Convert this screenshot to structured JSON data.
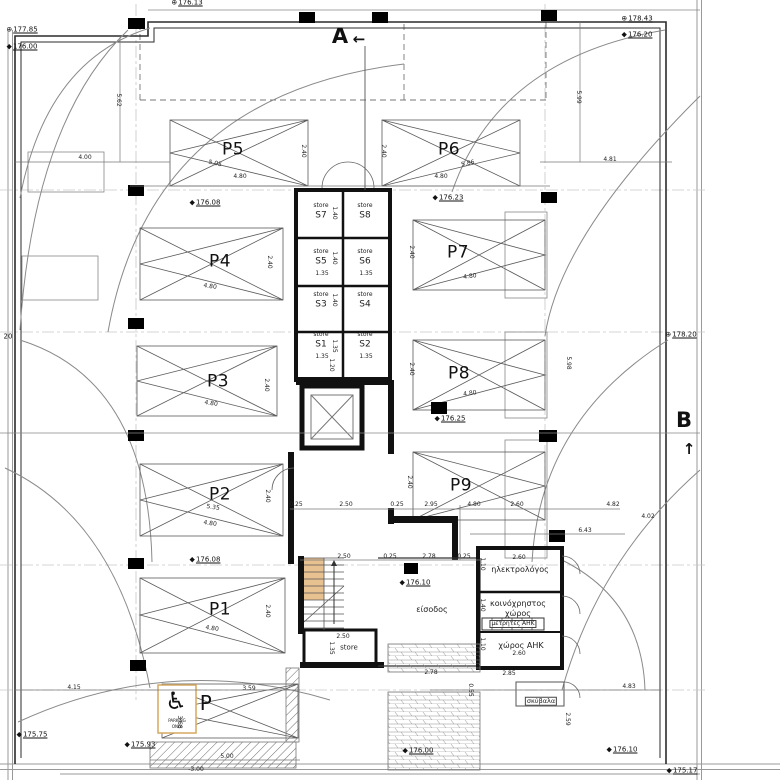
{
  "plan": {
    "colors": {
      "stair-fill": "#e8c191",
      "sign-border": "#d5a95f",
      "wall": "#111111"
    },
    "section_markers": [
      {
        "label": "A",
        "arrow": "←"
      },
      {
        "label": "B",
        "arrow": "↑"
      }
    ],
    "parking_labels": [
      {
        "t": "P5",
        "x": 233,
        "y": 150,
        "name": "parking-label-p5"
      },
      {
        "t": "P6",
        "x": 449,
        "y": 150,
        "name": "parking-label-p6"
      },
      {
        "t": "P4",
        "x": 220,
        "y": 262,
        "name": "parking-label-p4"
      },
      {
        "t": "P7",
        "x": 458,
        "y": 253,
        "name": "parking-label-p7"
      },
      {
        "t": "P3",
        "x": 218,
        "y": 382,
        "name": "parking-label-p3"
      },
      {
        "t": "P8",
        "x": 459,
        "y": 374,
        "name": "parking-label-p8"
      },
      {
        "t": "P2",
        "x": 220,
        "y": 495,
        "name": "parking-label-p2"
      },
      {
        "t": "P9",
        "x": 461,
        "y": 486,
        "name": "parking-label-p9"
      },
      {
        "t": "P1",
        "x": 220,
        "y": 610,
        "name": "parking-label-p1"
      },
      {
        "t": "P",
        "x": 206,
        "y": 703,
        "s": 20,
        "name": "parking-label-accessible"
      }
    ],
    "storage_labels": [
      {
        "t": "store",
        "x": 321,
        "y": 206,
        "s": 6
      },
      {
        "t": "S7",
        "x": 321,
        "y": 216
      },
      {
        "t": "store",
        "x": 365,
        "y": 206,
        "s": 6
      },
      {
        "t": "S8",
        "x": 365,
        "y": 216
      },
      {
        "t": "store",
        "x": 321,
        "y": 252,
        "s": 6
      },
      {
        "t": "S5",
        "x": 321,
        "y": 262
      },
      {
        "t": "store",
        "x": 365,
        "y": 252,
        "s": 6
      },
      {
        "t": "S6",
        "x": 365,
        "y": 262
      },
      {
        "t": "store",
        "x": 321,
        "y": 295,
        "s": 6
      },
      {
        "t": "S3",
        "x": 321,
        "y": 305
      },
      {
        "t": "store",
        "x": 365,
        "y": 295,
        "s": 6
      },
      {
        "t": "S4",
        "x": 365,
        "y": 305
      },
      {
        "t": "store",
        "x": 321,
        "y": 335,
        "s": 6
      },
      {
        "t": "S1",
        "x": 321,
        "y": 345
      },
      {
        "t": "store",
        "x": 365,
        "y": 335,
        "s": 6
      },
      {
        "t": "S2",
        "x": 365,
        "y": 345
      },
      {
        "t": "store",
        "x": 349,
        "y": 648,
        "s": 7
      }
    ],
    "room_labels": [
      {
        "t": "ηλεκτρολόγος",
        "x": 520,
        "y": 570
      },
      {
        "t": "κοινόχρηστος",
        "x": 518,
        "y": 604
      },
      {
        "t": "χώρος",
        "x": 518,
        "y": 614
      },
      {
        "t": "μετρητές ΑΗΚ",
        "x": 513,
        "y": 624,
        "s": 6,
        "box": true
      },
      {
        "t": "χώρος ΑΗΚ",
        "x": 521,
        "y": 646
      },
      {
        "t": "σκύβαλα",
        "x": 541,
        "y": 701,
        "s": 6.5,
        "box": true
      },
      {
        "t": "είσοδος",
        "x": 432,
        "y": 610
      }
    ],
    "elevation_markers": [
      {
        "t": "176.13",
        "x": 187,
        "y": 3,
        "a": "lt",
        "icon": "circle"
      },
      {
        "t": "177.85",
        "x": 22,
        "y": 30,
        "a": "lt",
        "icon": "circle"
      },
      {
        "t": "176.00",
        "x": 22,
        "y": 47,
        "a": "lt",
        "icon": "diamond"
      },
      {
        "t": "178.43",
        "x": 637,
        "y": 19,
        "a": "lt",
        "icon": "circle"
      },
      {
        "t": "176.20",
        "x": 637,
        "y": 35,
        "a": "lt",
        "icon": "diamond"
      },
      {
        "t": "176.08",
        "x": 205,
        "y": 203,
        "a": "lt",
        "icon": "diamond"
      },
      {
        "t": "176.23",
        "x": 448,
        "y": 198,
        "a": "lt",
        "icon": "diamond"
      },
      {
        "t": "178.20",
        "x": 681,
        "y": 335,
        "a": "lt",
        "icon": "circle"
      },
      {
        "t": "176.25",
        "x": 450,
        "y": 419,
        "a": "lt",
        "icon": "diamond"
      },
      {
        "t": "176.08",
        "x": 205,
        "y": 560,
        "a": "lt",
        "icon": "diamond"
      },
      {
        "t": "176.10",
        "x": 415,
        "y": 583,
        "a": "lt",
        "icon": "diamond"
      },
      {
        "t": "175.75",
        "x": 32,
        "y": 735,
        "a": "lt",
        "icon": "diamond"
      },
      {
        "t": "175.93",
        "x": 140,
        "y": 745,
        "a": "lt",
        "icon": "diamond"
      },
      {
        "t": "176.00",
        "x": 418,
        "y": 751,
        "a": "lt",
        "icon": "diamond"
      },
      {
        "t": "176.10",
        "x": 622,
        "y": 750,
        "a": "lt",
        "icon": "diamond"
      },
      {
        "t": "175.17",
        "x": 682,
        "y": 771,
        "a": "lt",
        "icon": "diamond"
      }
    ],
    "dimensions": [
      {
        "t": "5.62",
        "x": 118,
        "y": 100,
        "r": 90
      },
      {
        "t": "5.99",
        "x": 578,
        "y": 97,
        "r": 90
      },
      {
        "t": "4.00",
        "x": 85,
        "y": 158
      },
      {
        "t": "4.81",
        "x": 610,
        "y": 160
      },
      {
        "t": "5.05",
        "x": 215,
        "y": 164,
        "r": 12
      },
      {
        "t": "4.80",
        "x": 240,
        "y": 177
      },
      {
        "t": "5.86",
        "x": 468,
        "y": 164,
        "r": -12
      },
      {
        "t": "4.80",
        "x": 441,
        "y": 177
      },
      {
        "t": "2.40",
        "x": 303,
        "y": 151,
        "r": 90
      },
      {
        "t": "2.40",
        "x": 383,
        "y": 151,
        "r": 90
      },
      {
        "t": "2.40",
        "x": 269,
        "y": 262,
        "r": 90
      },
      {
        "t": "4.80",
        "x": 210,
        "y": 287,
        "r": 8
      },
      {
        "t": "2.40",
        "x": 411,
        "y": 252,
        "r": 90
      },
      {
        "t": "4.80",
        "x": 470,
        "y": 277,
        "r": -8
      },
      {
        "t": "2.40",
        "x": 266,
        "y": 385,
        "r": 90
      },
      {
        "t": "4.80",
        "x": 211,
        "y": 404,
        "r": 8
      },
      {
        "t": "2.40",
        "x": 411,
        "y": 369,
        "r": 90
      },
      {
        "t": "4.80",
        "x": 470,
        "y": 394,
        "r": -8
      },
      {
        "t": "2.40",
        "x": 267,
        "y": 496,
        "r": 90
      },
      {
        "t": "5.35",
        "x": 213,
        "y": 508,
        "r": 8
      },
      {
        "t": "4.80",
        "x": 210,
        "y": 524,
        "r": 8
      },
      {
        "t": "2.40",
        "x": 409,
        "y": 482,
        "r": 90
      },
      {
        "t": "2.40",
        "x": 267,
        "y": 611,
        "r": 90
      },
      {
        "t": "4.80",
        "x": 212,
        "y": 629,
        "r": 8
      },
      {
        "t": "1.40",
        "x": 334,
        "y": 213,
        "r": 90
      },
      {
        "t": "1.40",
        "x": 334,
        "y": 258,
        "r": 90
      },
      {
        "t": "1.40",
        "x": 334,
        "y": 300,
        "r": 90
      },
      {
        "t": "1.35",
        "x": 322,
        "y": 274
      },
      {
        "t": "1.35",
        "x": 366,
        "y": 274
      },
      {
        "t": "1.35",
        "x": 334,
        "y": 346,
        "r": 90
      },
      {
        "t": "1.35",
        "x": 322,
        "y": 357
      },
      {
        "t": "1.35",
        "x": 366,
        "y": 357
      },
      {
        "t": "1.20",
        "x": 331,
        "y": 365,
        "r": 90
      },
      {
        "t": "0.25",
        "x": 296,
        "y": 505
      },
      {
        "t": "2.50",
        "x": 346,
        "y": 505
      },
      {
        "t": "0.25",
        "x": 397,
        "y": 505
      },
      {
        "t": "2.95",
        "x": 431,
        "y": 505
      },
      {
        "t": "4.80",
        "x": 474,
        "y": 505
      },
      {
        "t": "2.60",
        "x": 517,
        "y": 505
      },
      {
        "t": "4.82",
        "x": 613,
        "y": 505
      },
      {
        "t": "4.02",
        "x": 648,
        "y": 517
      },
      {
        "t": "6.43",
        "x": 585,
        "y": 531
      },
      {
        "t": "2.50",
        "x": 344,
        "y": 557
      },
      {
        "t": "0.25",
        "x": 390,
        "y": 557
      },
      {
        "t": "2.78",
        "x": 429,
        "y": 557
      },
      {
        "t": "0.25",
        "x": 464,
        "y": 557
      },
      {
        "t": "2.60",
        "x": 519,
        "y": 558
      },
      {
        "t": "1.10",
        "x": 482,
        "y": 564,
        "r": 90
      },
      {
        "t": "1.40",
        "x": 482,
        "y": 605,
        "r": 90
      },
      {
        "t": "1.10",
        "x": 482,
        "y": 644,
        "r": 90
      },
      {
        "t": "2.60",
        "x": 519,
        "y": 654
      },
      {
        "t": "2.50",
        "x": 343,
        "y": 637
      },
      {
        "t": "1.35",
        "x": 331,
        "y": 648,
        "r": 90
      },
      {
        "t": "2.78",
        "x": 431,
        "y": 673
      },
      {
        "t": "0.55",
        "x": 470,
        "y": 690,
        "r": 90
      },
      {
        "t": "2.85",
        "x": 509,
        "y": 674
      },
      {
        "t": "2.59",
        "x": 567,
        "y": 719,
        "r": 90
      },
      {
        "t": "4.83",
        "x": 629,
        "y": 687
      },
      {
        "t": "4.15",
        "x": 74,
        "y": 688
      },
      {
        "t": "3.59",
        "x": 249,
        "y": 689
      },
      {
        "t": "3.68",
        "x": 179,
        "y": 722,
        "r": 90
      },
      {
        "t": "5.00",
        "x": 227,
        "y": 757
      },
      {
        "t": "-3.00",
        "x": 196,
        "y": 770
      },
      {
        "t": "5.98",
        "x": 568,
        "y": 363,
        "r": 90
      }
    ],
    "misc_labels": [
      {
        "t": "♿",
        "x": 176,
        "y": 701,
        "s": 24,
        "name": "wheelchair-icon"
      },
      {
        "t": "PARKING",
        "x": 177,
        "y": 721,
        "s": 4,
        "name": "accessible-sign-text"
      },
      {
        "t": "ONLY",
        "x": 177,
        "y": 727,
        "s": 4,
        "name": "accessible-sign-text"
      },
      {
        "t": "20",
        "x": 8,
        "y": 337,
        "s": 7,
        "name": "edge-label"
      }
    ]
  }
}
